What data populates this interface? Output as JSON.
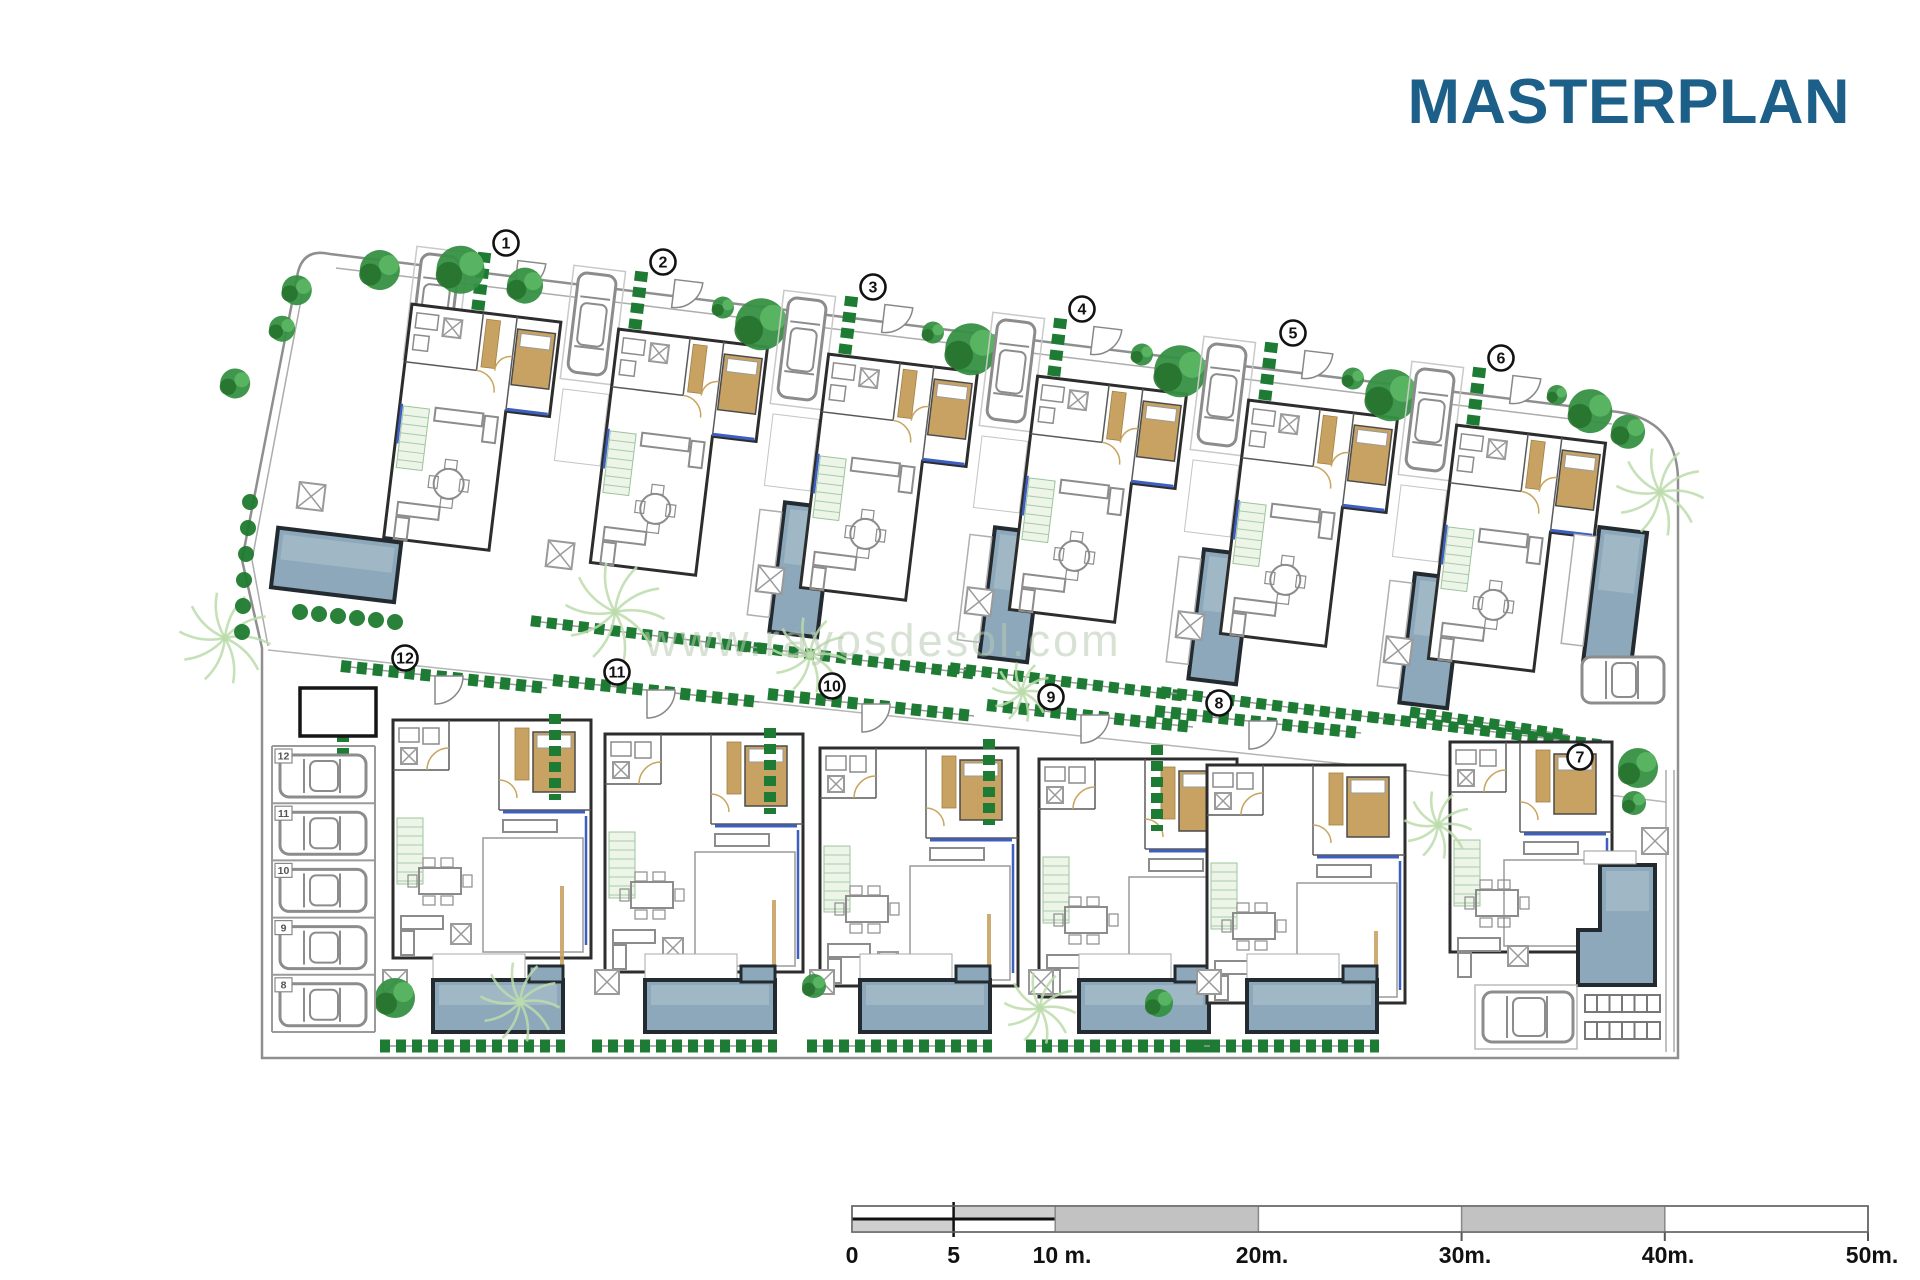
{
  "title": "MASTERPLAN",
  "watermark": "www.rayosdesol.com",
  "site": {
    "plots_top": [
      {
        "label": "1",
        "x": 506,
        "y": 243
      },
      {
        "label": "2",
        "x": 663,
        "y": 262
      },
      {
        "label": "3",
        "x": 873,
        "y": 287
      },
      {
        "label": "4",
        "x": 1082,
        "y": 309
      },
      {
        "label": "5",
        "x": 1293,
        "y": 333
      },
      {
        "label": "6",
        "x": 1501,
        "y": 358
      }
    ],
    "plots_bottom": [
      {
        "label": "12",
        "x": 405,
        "y": 658
      },
      {
        "label": "11",
        "x": 617,
        "y": 672
      },
      {
        "label": "10",
        "x": 832,
        "y": 686
      },
      {
        "label": "9",
        "x": 1051,
        "y": 697
      },
      {
        "label": "8",
        "x": 1219,
        "y": 703
      },
      {
        "label": "7",
        "x": 1580,
        "y": 757
      }
    ]
  },
  "parking": {
    "stalls": [
      "12",
      "11",
      "10",
      "9",
      "8"
    ]
  },
  "scalebar": {
    "labels": [
      {
        "text": "0",
        "x": 852
      },
      {
        "text": "5",
        "x": 953.6
      },
      {
        "text": "10 m.",
        "x": 1062
      },
      {
        "text": "20m.",
        "x": 1262
      },
      {
        "text": "30m.",
        "x": 1465
      },
      {
        "text": "40m.",
        "x": 1668
      },
      {
        "text": "50m.",
        "x": 1872
      }
    ]
  },
  "colors": {
    "title": "#1C5F88",
    "pool": "#8DA8BB",
    "pool_light": "#A7BCC9",
    "pool_dark": "#232B31",
    "wall": "#2D2D2D",
    "furniture": "#8C8C8C",
    "tan": "#C8A263",
    "hedge": "#1E7B33",
    "tree": "#359042",
    "tree_dark": "#27722F",
    "tree_light": "#5CB765",
    "palm": "#BCDCAC",
    "pipe": "#3C5FC0",
    "boundary": "#8F8F8F",
    "scale_gray": "#C2C2C2",
    "scale_gray_light": "#CFCFCF",
    "text": "#111111"
  }
}
